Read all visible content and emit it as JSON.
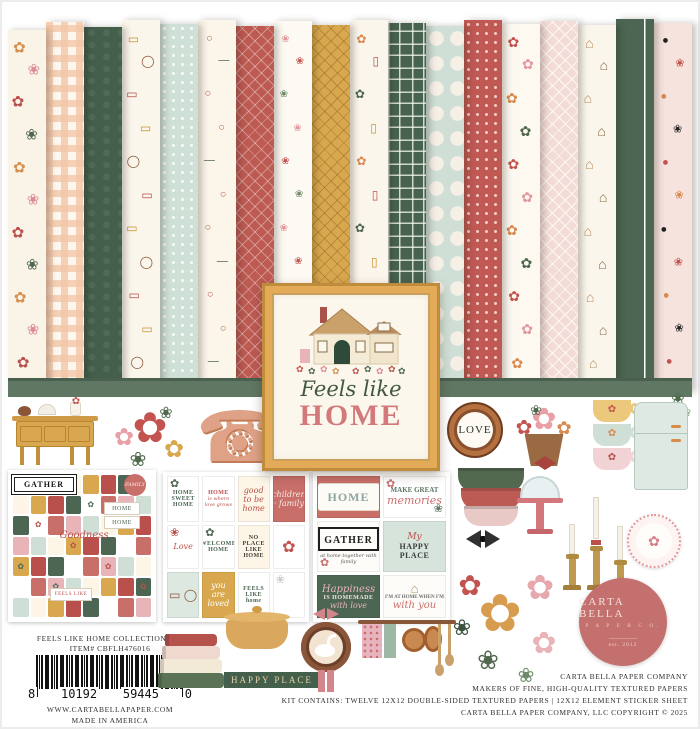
{
  "frame": {
    "script": "Feels like",
    "title": "HOME"
  },
  "love_label": "LOVE",
  "happy_place_label": "HAPPY PLACE",
  "papers": [
    {
      "name": "large floral cream",
      "pattern": "glyphs",
      "base": "#faf3e8",
      "glyphs": [
        "✿",
        "❀"
      ],
      "colors": [
        "#d78f4e",
        "#dd8e95",
        "#b9504b",
        "#4f684d"
      ],
      "size": 15
    },
    {
      "name": "peach gingham",
      "pattern": "gingham",
      "base": "#fdf7ef",
      "acc": "rgba(243,198,167,0.8)"
    },
    {
      "name": "dark green tonal floral",
      "pattern": "tonal",
      "base": "#44604c",
      "acc": "rgba(255,255,255,0.07)"
    },
    {
      "name": "gallery wall frames",
      "pattern": "glyphs",
      "base": "#fbf6ec",
      "glyphs": [
        "▭",
        "◯",
        "▭"
      ],
      "colors": [
        "#c9932f",
        "#8a5639",
        "#b9504b"
      ],
      "size": 12
    },
    {
      "name": "mint polka dot",
      "pattern": "dots",
      "base": "#cfe0d6",
      "acc": "rgba(255,255,255,0.85)"
    },
    {
      "name": "hanging kitchen pans",
      "pattern": "glyphs",
      "base": "#fbf5ea",
      "glyphs": [
        "○",
        "—",
        "○"
      ],
      "colors": [
        "#b06a3e",
        "#52684f",
        "#c2534f"
      ],
      "size": 11
    },
    {
      "name": "red diamond lattice",
      "pattern": "lattice",
      "base": "#bd5a52",
      "acc": "rgba(255,255,255,0.35)"
    },
    {
      "name": "floral sprigs",
      "pattern": "glyphs",
      "base": "#fdfaf3",
      "glyphs": [
        "❀"
      ],
      "colors": [
        "#e3969d",
        "#c2534f",
        "#6d8a67"
      ],
      "size": 10
    },
    {
      "name": "mustard diamond grid",
      "pattern": "lattice",
      "base": "#d9a84e",
      "acc": "rgba(120,85,20,0.35)"
    },
    {
      "name": "flower pots and vases",
      "pattern": "glyphs",
      "base": "#fbf6ec",
      "glyphs": [
        "✿",
        "▯"
      ],
      "colors": [
        "#d9884e",
        "#b9504b",
        "#4f684d",
        "#c9932f"
      ],
      "size": 12
    },
    {
      "name": "green plaid",
      "pattern": "plaid",
      "base": "#47634f",
      "acc": "rgba(240,245,238,0.8)"
    },
    {
      "name": "doily plates mint",
      "pattern": "bigdots",
      "base": "#cfdfd6",
      "acc": "#f6efe6"
    },
    {
      "name": "rose ditsy",
      "pattern": "dots",
      "base": "#c05953",
      "acc": "rgba(255,230,225,0.8)"
    },
    {
      "name": "large roses",
      "pattern": "glyphs",
      "base": "#fdf9f1",
      "glyphs": [
        "✿"
      ],
      "colors": [
        "#c2534f",
        "#e3969d",
        "#d9884e",
        "#4f684d"
      ],
      "size": 14
    },
    {
      "name": "blush trellis",
      "pattern": "lattice",
      "base": "#f4dcd6",
      "acc": "rgba(255,255,255,0.75)"
    },
    {
      "name": "cottages",
      "pattern": "glyphs",
      "base": "#fbf6ec",
      "glyphs": [
        "⌂"
      ],
      "colors": [
        "#b98d5f",
        "#8a6b46"
      ],
      "size": 14
    },
    {
      "name": "dark green stripe",
      "pattern": "stripe",
      "base": "#4c6653",
      "acc": "rgba(255,255,255,0.25)"
    },
    {
      "name": "tags with roses",
      "pattern": "glyphs",
      "base": "#f6e3dd",
      "glyphs": [
        "●",
        "❀"
      ],
      "colors": [
        "#222222",
        "#c2534f",
        "#d9884e"
      ],
      "size": 11
    }
  ],
  "sticker_sheet": {
    "palette": [
      "#c96f6a",
      "#fdf6e7",
      "#4c6653",
      "#e8b4b8",
      "#d9a84e",
      "#ffffff",
      "#cfdfd6",
      "#b9504b"
    ],
    "glyph": "✿",
    "labels": {
      "gather": "GATHER",
      "family": "FAMILY",
      "home1": "HOME",
      "home2": "HOME",
      "script": "Goodness",
      "feels": "FEELS LIKE"
    }
  },
  "small_cards": [
    {
      "t": "HOME SWEET HOME",
      "style": "caps",
      "bg": "#ffffff",
      "fg": "#4c6653",
      "corner": "✿"
    },
    {
      "t": "HOME",
      "sub": "is where love grows",
      "style": "caps",
      "bg": "#ffffff",
      "fg": "#b9504b"
    },
    {
      "t": "good to be home",
      "style": "script",
      "bg": "#fdf6e7",
      "fg": "#b9504b"
    },
    {
      "t": "children · family",
      "style": "script",
      "bg": "#c96f6a",
      "fg": "#f7e9e4"
    },
    {
      "t": "Love",
      "style": "script",
      "bg": "#ffffff",
      "fg": "#b9504b",
      "corner": "❀"
    },
    {
      "t": "WELCOME HOME",
      "style": "caps",
      "bg": "#ffffff",
      "fg": "#4c6653",
      "corner": "✿"
    },
    {
      "t": "NO PLACE LIKE HOME",
      "style": "caps",
      "bg": "#fdf6e7",
      "fg": "#44413c"
    },
    {
      "t": "✿",
      "style": "floral",
      "bg": "#ffffff",
      "fg": "#c2534f"
    },
    {
      "t": "",
      "style": "scene",
      "bg": "#dce8e0",
      "fg": "#8a5639"
    },
    {
      "t": "you are loved",
      "style": "script",
      "bg": "#d9a84e",
      "fg": "#ffffff"
    },
    {
      "t": "FEELS LIKE home",
      "style": "caps",
      "bg": "#ffffff",
      "fg": "#4c6653"
    },
    {
      "t": "",
      "style": "blank",
      "bg": "#ffffff",
      "fg": "#cccccc",
      "corner": "❀"
    }
  ],
  "large_cards": [
    {
      "style": "plaque",
      "t": "HOME",
      "bg": "#c96f6a",
      "fg": "#8fa5a0"
    },
    {
      "style": "memories",
      "t": "MAKE GREAT",
      "t2": "memories",
      "bg": "#ffffff",
      "fg": "#5f7763",
      "fg2": "#cb6f6d"
    },
    {
      "style": "gather",
      "t": "GATHER",
      "sub": "at home together with family",
      "bg": "#fdfcf8",
      "fg": "#1e1e1e"
    },
    {
      "style": "happy",
      "t": "My",
      "t2": "HAPPY PLACE",
      "bg": "#d7e4dc",
      "fg": "#3c3c3c",
      "fg2": "#b9504b"
    },
    {
      "style": "happiness",
      "t": "Happiness",
      "t2": "IS HOMEMADE",
      "t3": "with love",
      "bg": "#4c6653",
      "fg": "#e8b4b8"
    },
    {
      "style": "withyou",
      "t": "I'M AT HOME WHEN I'M",
      "t2": "with you",
      "bg": "#fdfcf8",
      "fg": "#6b6b6b",
      "fg2": "#cb6f6d"
    }
  ],
  "footer_left": {
    "line1": "FEELS LIKE HOME COLLECTION KIT",
    "line2": "ITEM# CBFLH476016",
    "barcode": {
      "d1": "8",
      "d2": "10192",
      "d3": "59445",
      "d4": "0"
    },
    "website": "WWW.CARTABELLAPAPER.COM",
    "made_in": "MADE IN AMERICA"
  },
  "footer_right": {
    "line1": "CARTA BELLA PAPER COMPANY",
    "line2": "MAKERS OF FINE, HIGH-QUALITY TEXTURED PAPERS",
    "line3": "KIT CONTAINS: TWELVE 12X12 DOUBLE-SIDED TEXTURED PAPERS | 12X12 ELEMENT STICKER SHEET",
    "line4": "CARTA BELLA PAPER COMPANY, LLC COPYRIGHT © 2025"
  },
  "logo": {
    "name": "CARTA BELLA",
    "sub": "P A P E R   C O.",
    "est": "est. 2012"
  },
  "colors": {
    "brand_rose": "#c4706f",
    "deep_green": "#4c6653",
    "shelf_green": "#5f7763",
    "frame_gold": "#e3aa58",
    "title_pink": "#d4797b",
    "script_green": "#41583f"
  }
}
